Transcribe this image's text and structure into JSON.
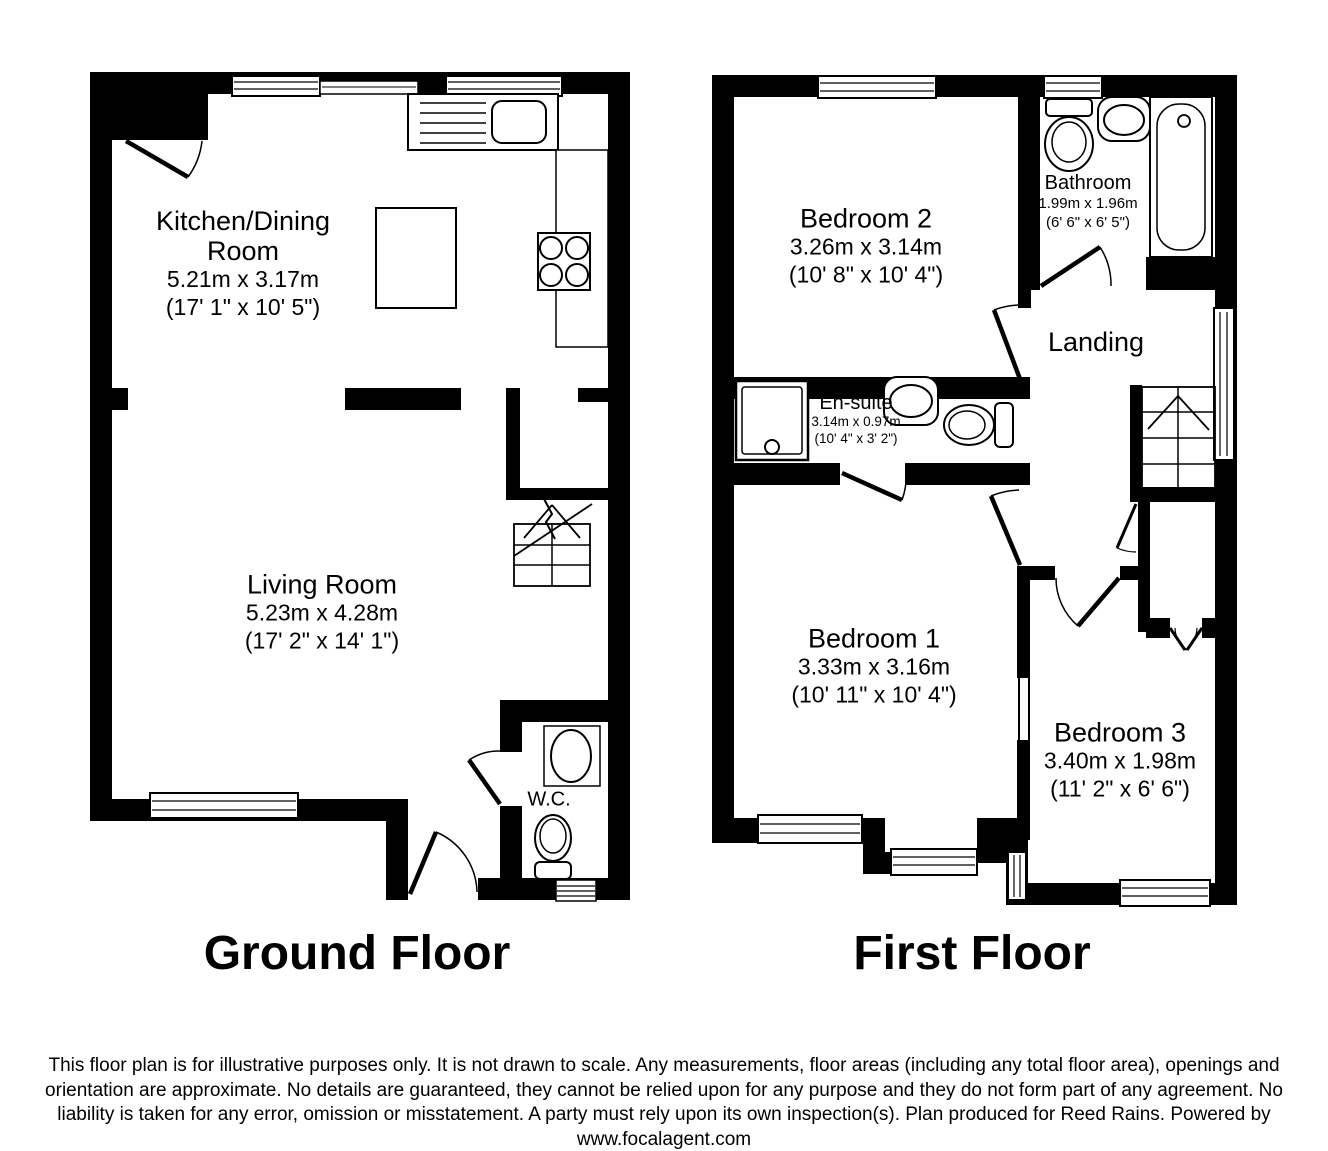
{
  "ground_floor": {
    "title": "Ground Floor",
    "rooms": {
      "kitchen_dining": {
        "name": "Kitchen/Dining Room",
        "metric": "5.21m x 3.17m",
        "imperial": "(17' 1\" x 10' 5\")"
      },
      "living_room": {
        "name": "Living Room",
        "metric": "5.23m x 4.28m",
        "imperial": "(17' 2\" x 14' 1\")"
      },
      "wc": {
        "name": "W.C."
      }
    }
  },
  "first_floor": {
    "title": "First Floor",
    "rooms": {
      "bedroom_2": {
        "name": "Bedroom 2",
        "metric": "3.26m x 3.14m",
        "imperial": "(10' 8\" x 10' 4\")"
      },
      "bathroom": {
        "name": "Bathroom",
        "metric": "1.99m x 1.96m",
        "imperial": "(6' 6\" x 6' 5\")"
      },
      "landing": {
        "name": "Landing"
      },
      "en_suite": {
        "name": "En-suite",
        "metric": "3.14m x 0.97m",
        "imperial": "(10' 4\" x 3' 2\")"
      },
      "bedroom_1": {
        "name": "Bedroom 1",
        "metric": "3.33m x 3.16m",
        "imperial": "(10' 11\" x 10' 4\")"
      },
      "bedroom_3": {
        "name": "Bedroom 3",
        "metric": "3.40m x 1.98m",
        "imperial": "(11' 2\" x 6' 6\")"
      }
    }
  },
  "footer": {
    "disclaimer": "This floor plan is for illustrative purposes only. It is not drawn to scale. Any measurements, floor areas (including any total floor area), openings and orientation are approximate. No details are guaranteed, they cannot be relied upon for any purpose and they do not form part of any agreement. No liability is taken for any error, omission or misstatement. A party must rely upon its own inspection(s). Plan produced for Reed Rains. Powered by",
    "website": "www.focalagent.com"
  },
  "colors": {
    "wall": "#000000",
    "line": "#000000",
    "background": "#ffffff"
  }
}
